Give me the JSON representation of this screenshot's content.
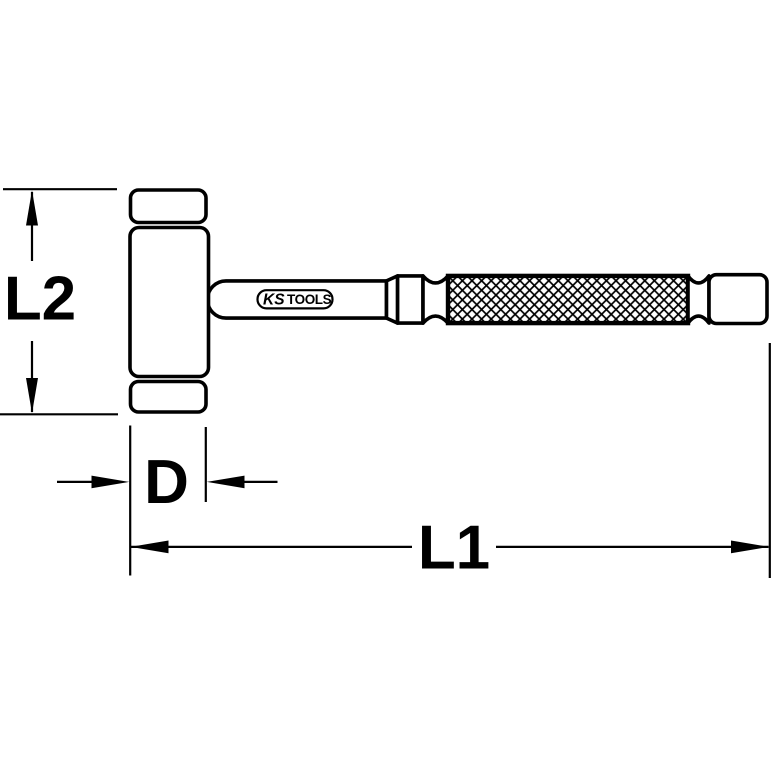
{
  "colors": {
    "line_color": "#000000",
    "background": "#ffffff"
  },
  "logo": {
    "brand_prefix": "KS",
    "brand_suffix": "TOOLS"
  },
  "dimensions": {
    "head_height": {
      "label": "L2"
    },
    "head_diameter": {
      "label": "D"
    },
    "total_length": {
      "label": "L1"
    }
  }
}
